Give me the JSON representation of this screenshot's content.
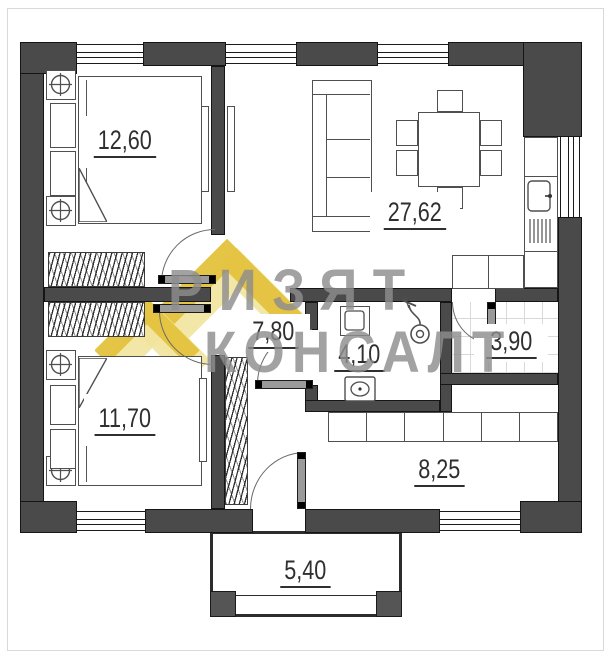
{
  "watermark": {
    "line1": "РИЗЯТ",
    "line2": "КОНСАЛТ"
  },
  "rooms": {
    "bedroom_top": {
      "area": "12,60"
    },
    "living_kitchen": {
      "area": "27,62"
    },
    "bedroom_bottom": {
      "area": "11,70"
    },
    "hallway": {
      "area": "7,80"
    },
    "bathroom": {
      "area": "4,10"
    },
    "utility": {
      "area": "3,90"
    },
    "entry": {
      "area": "8,25"
    },
    "porch": {
      "area": "5,40"
    }
  },
  "colors": {
    "wall": "#4a4a4a",
    "watermark_gold": "#e3c23c",
    "watermark_pale": "#f2e6a2",
    "watermark_text": "#8e8e8e"
  }
}
